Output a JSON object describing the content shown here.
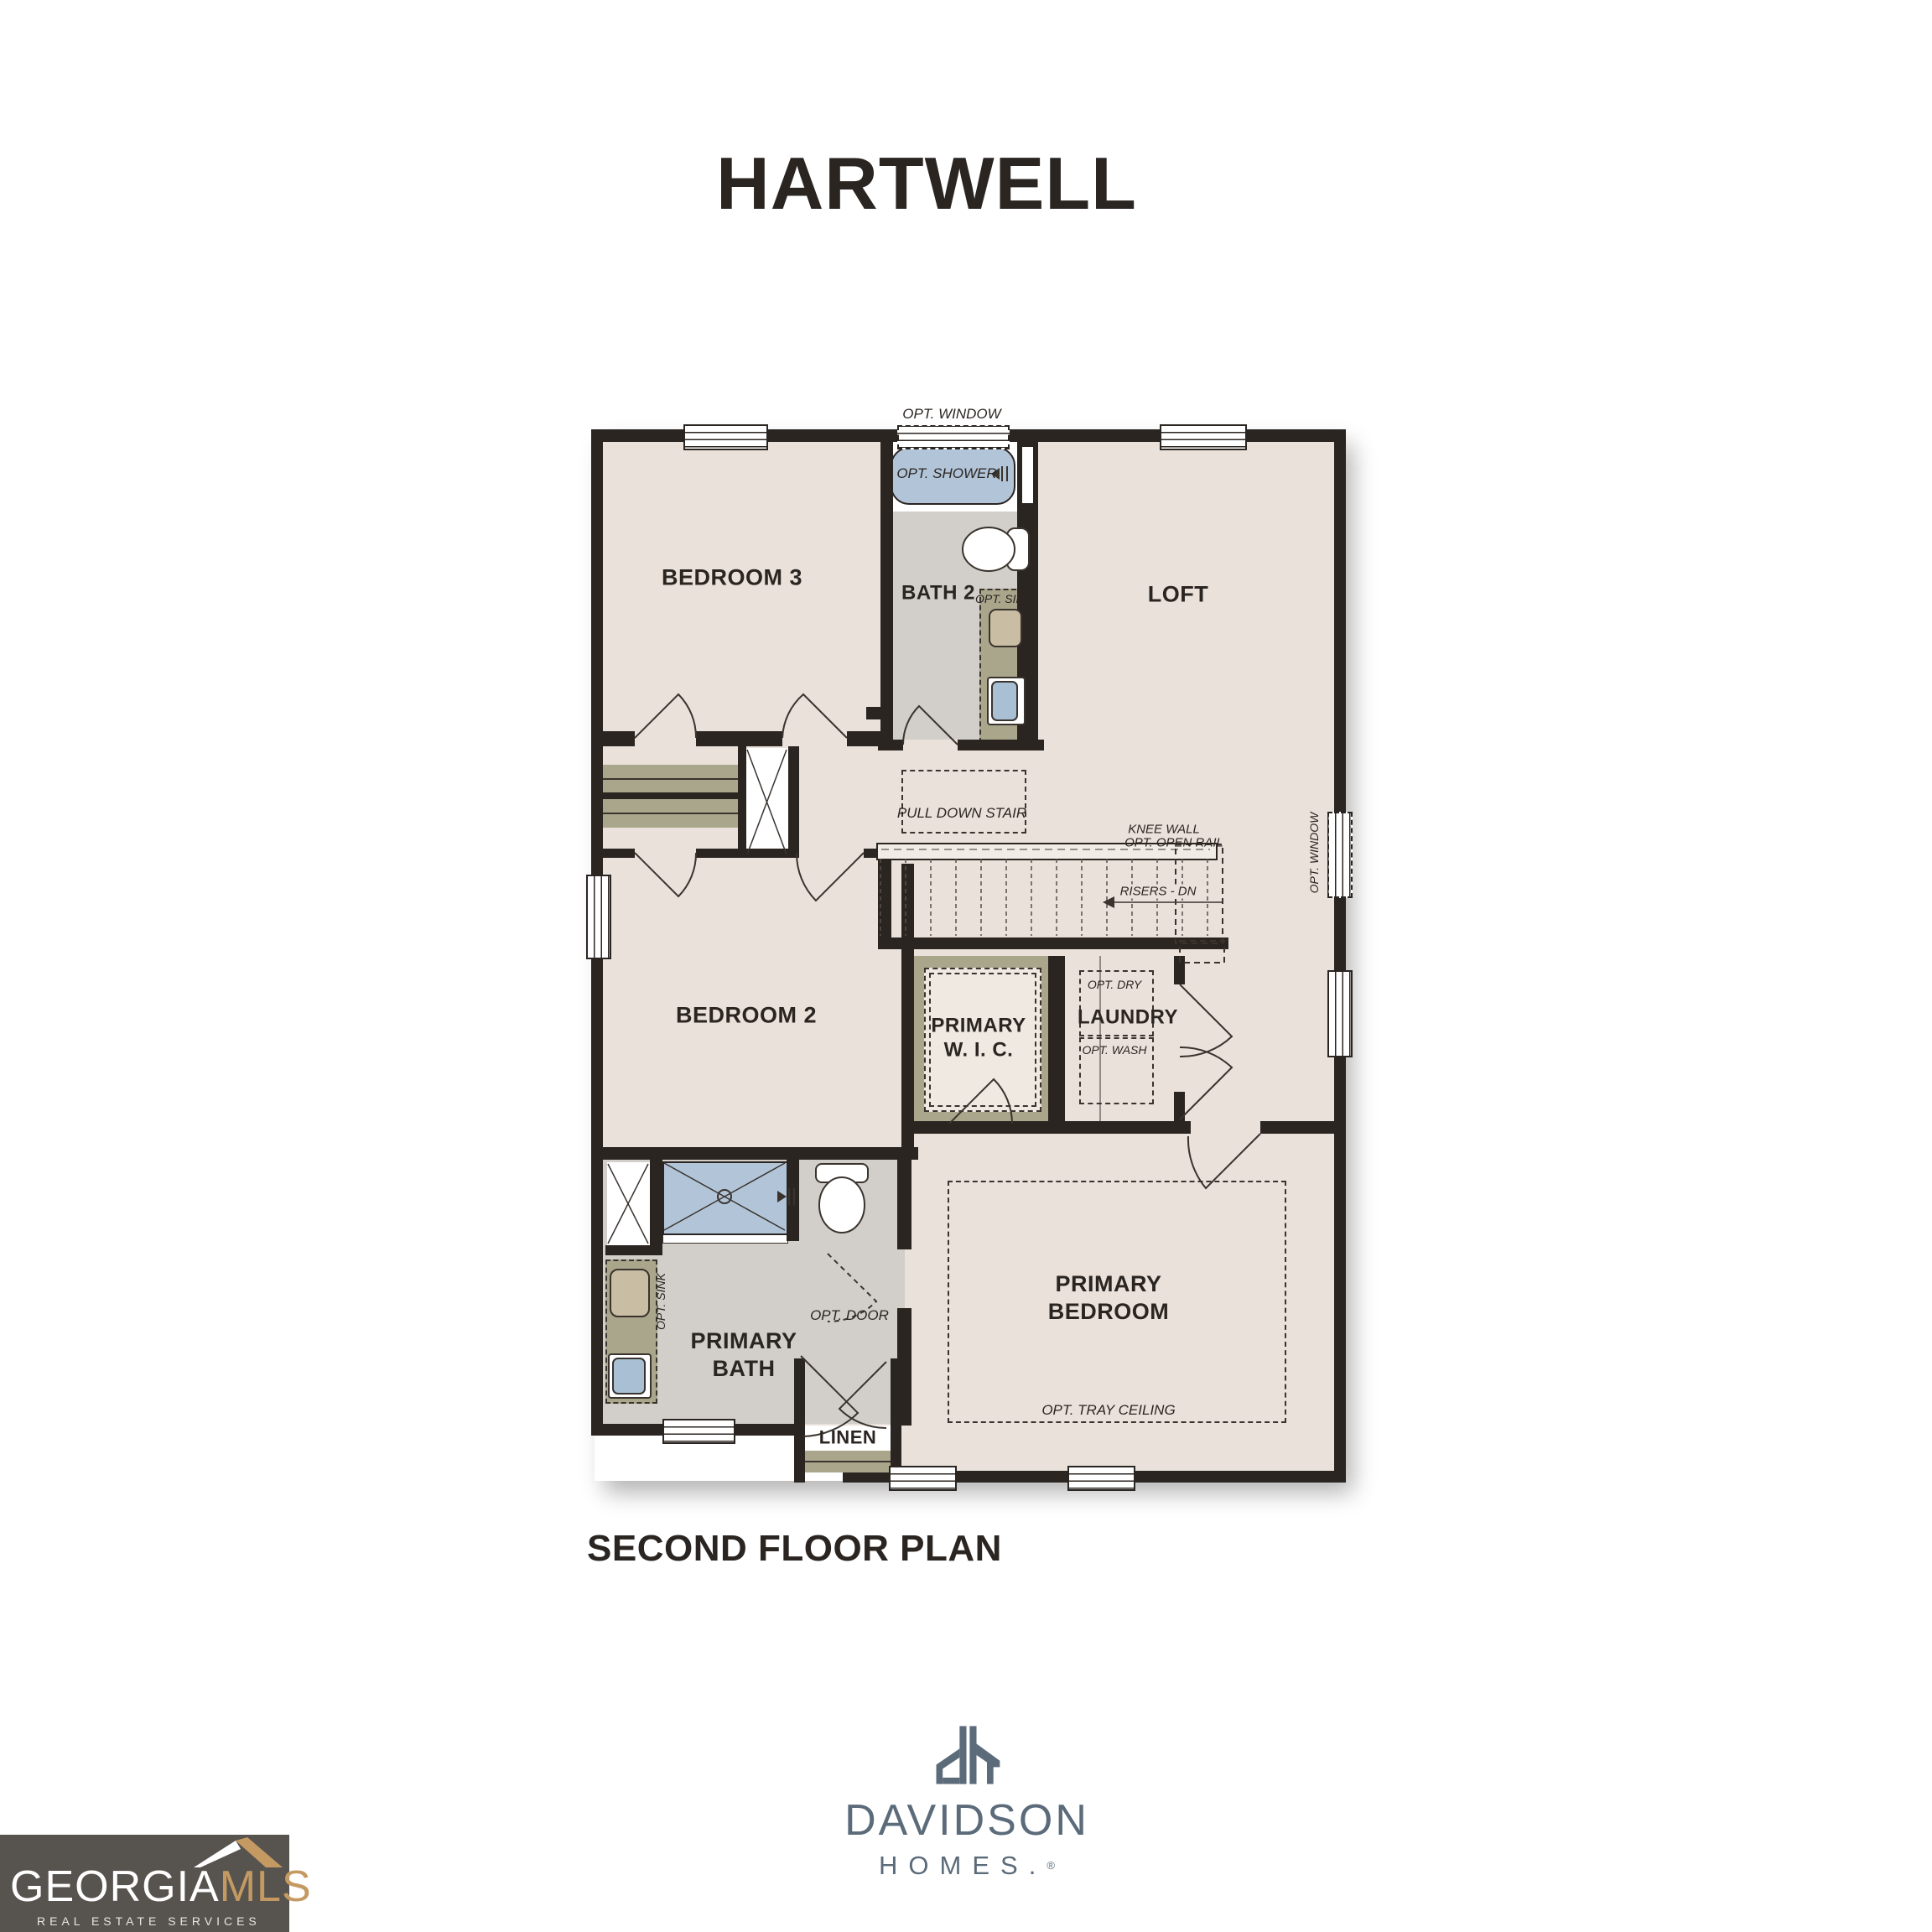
{
  "title": "HARTWELL",
  "caption": "SECOND FLOOR PLAN",
  "plan": {
    "rooms": {
      "bedroom3": "BEDROOM 3",
      "bath2": "BATH 2",
      "loft": "LOFT",
      "bedroom2": "BEDROOM 2",
      "primary_wic_l1": "PRIMARY",
      "primary_wic_l2": "W. I. C.",
      "laundry": "LAUNDRY",
      "primary_bath_l1": "PRIMARY",
      "primary_bath_l2": "BATH",
      "primary_bedroom_l1": "PRIMARY",
      "primary_bedroom_l2": "BEDROOM",
      "linen": "LINEN"
    },
    "annotations": {
      "opt_window_top": "OPT. WINDOW",
      "opt_shower": "OPT. SHOWER",
      "opt_sink_bath2": "OPT. SINK",
      "pull_down_stair": "PULL DOWN STAIR",
      "knee_wall_l1": "KNEE WALL",
      "knee_wall_l2": "OPT. OPEN RAIL",
      "risers_dn": "RISERS - DN",
      "opt_window_right": "OPT. WINDOW",
      "opt_dry": "OPT. DRY",
      "opt_wash": "OPT. WASH",
      "opt_door": "OPT. DOOR",
      "opt_sink_primary": "OPT. SINK",
      "opt_tray_ceiling": "OPT. TRAY CEILING"
    }
  },
  "branding": {
    "davidson": {
      "name": "DAVIDSON",
      "homes": "HOMES.",
      "reg": "®"
    },
    "georgia_mls": {
      "georgia": "GEORGIA",
      "mls": "MLS",
      "tagline": "REAL ESTATE SERVICES"
    }
  },
  "colors": {
    "wall": "#2b2522",
    "floor": "#e9e1da",
    "bath_floor": "#d2cfca",
    "closet_olive": "#a9a68c",
    "fixture_blue": "#b2c5d8",
    "logo_slate": "#5b6b7a",
    "mls_gold": "#c49a62",
    "mls_background": "#57544f"
  }
}
